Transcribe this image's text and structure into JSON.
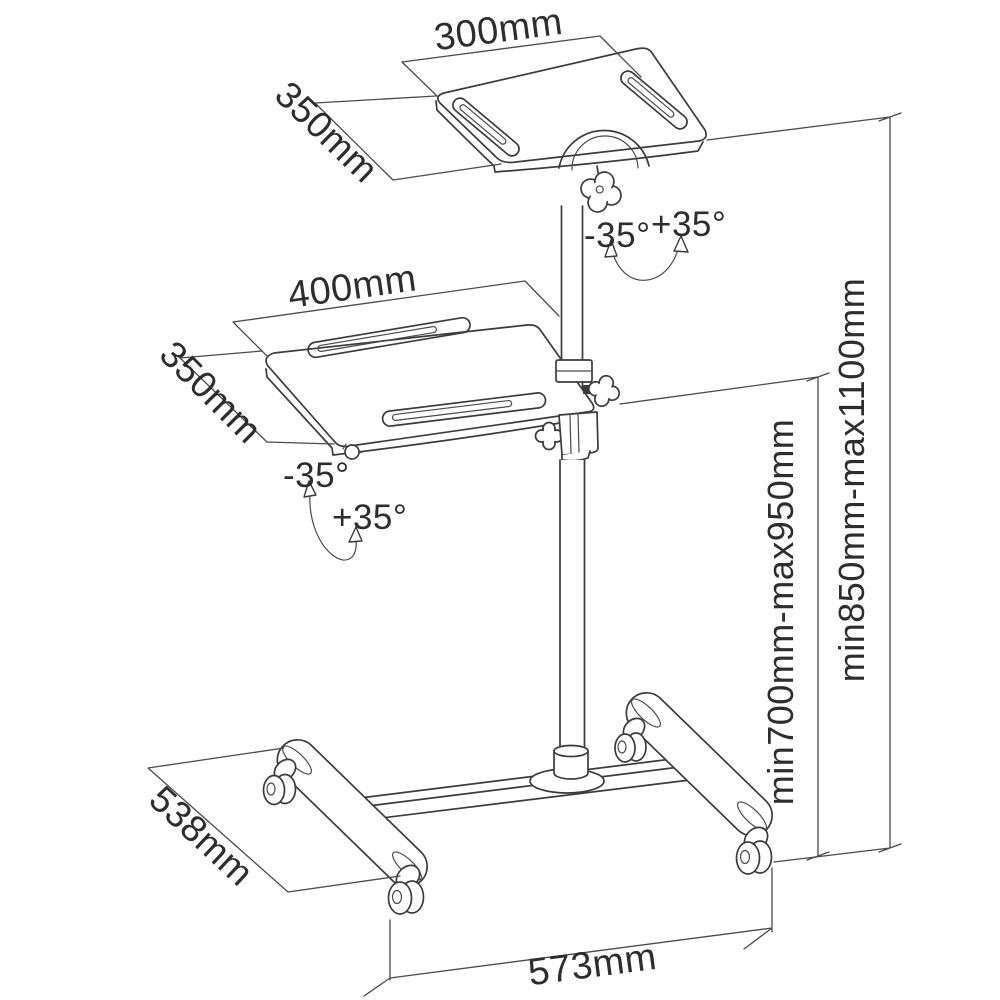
{
  "diagram": {
    "colors": {
      "line": "#3b3b3b",
      "text": "#2d2d2d",
      "background": "#ffffff"
    },
    "dimensions": {
      "top_platform_width": "300mm",
      "top_platform_depth": "350mm",
      "middle_platform_width": "400mm",
      "middle_platform_depth": "350mm",
      "top_tilt_negative": "-35°",
      "top_tilt_positive": "+35°",
      "middle_tilt_negative": "-35°",
      "middle_tilt_positive": "+35°",
      "overall_height_range": "min850mm-max1100mm",
      "middle_height_range": "min700mm-max950mm",
      "base_depth": "538mm",
      "base_width": "573mm"
    }
  }
}
